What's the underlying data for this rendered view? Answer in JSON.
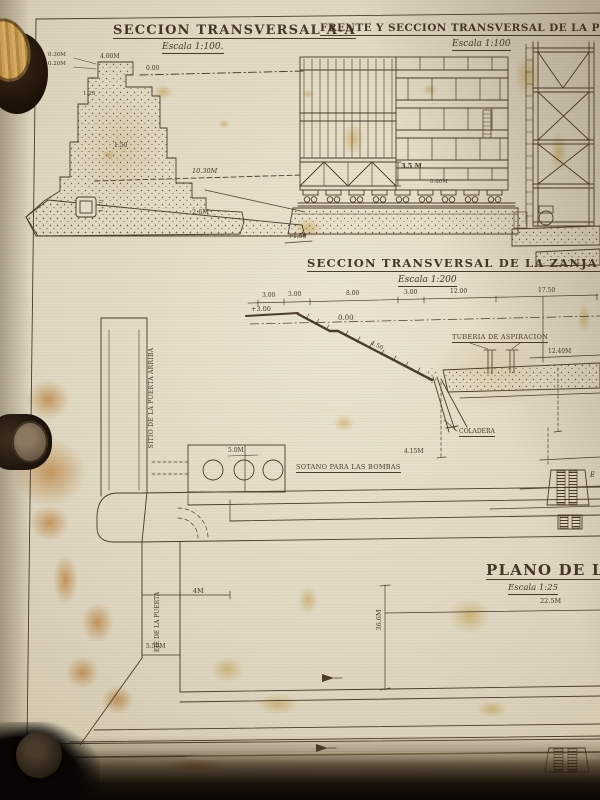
{
  "palette": {
    "paper": "#ded6c0",
    "ink": "#4a3b2a",
    "stain_orange": "#c87616",
    "stain_yellow": "#cc9e2a",
    "background_dark": "#171008",
    "wood_knob": "#c9a35f"
  },
  "seccion_aa": {
    "title": "SECCION TRANSVERSAL A-A",
    "scale": "Escala 1:100.",
    "dim_top": "4.00M",
    "dim_top2": "0.30M",
    "dim_top3": "0.20M",
    "dim_water": "0.00",
    "dim_step1": "1.25",
    "dim_step2": "1.50",
    "dim_base_len": "10.30M",
    "dim_base_h": "2.6M",
    "dim_culvert": "1.10"
  },
  "frente": {
    "title": "FRENTE Y SECCION TRANSVERSAL DE LA PUERTA CORRE",
    "scale": "Escala 1:100",
    "dim_gate": "3.5 M",
    "dim_roller": "0.60M"
  },
  "zanja": {
    "title": "SECCION TRANSVERSAL DE LA ZANJA DE FUNDACION",
    "scale": "Escala 1:200",
    "d1": "3.00",
    "d2": "3.00",
    "d3": "8.00",
    "d4": "3.00",
    "d5": "12.00",
    "d6": "17.50",
    "ground": "+3.00",
    "water": "0.00",
    "slope": "4.50",
    "right_dim": "12.40M",
    "depth": "4.15M",
    "datum": "+1.50",
    "tuberia": "TUBERIA DE ASPIRACION",
    "coladera": "COLADERA"
  },
  "plano": {
    "title": "PLANO DE LA CA",
    "scale": "Escala 1:25",
    "sub_dim": "22.5M",
    "len": "36.6M",
    "chan_w": "5.50M",
    "chan_d": "4M",
    "sump_w": "5.0M",
    "sitio": "SITIO DE LA PUERTA ARRIBA",
    "eje": "EJE DE LA PUERTA",
    "sotano": "SOTANO PARA LAS BOMBAS",
    "fragment": "E"
  }
}
